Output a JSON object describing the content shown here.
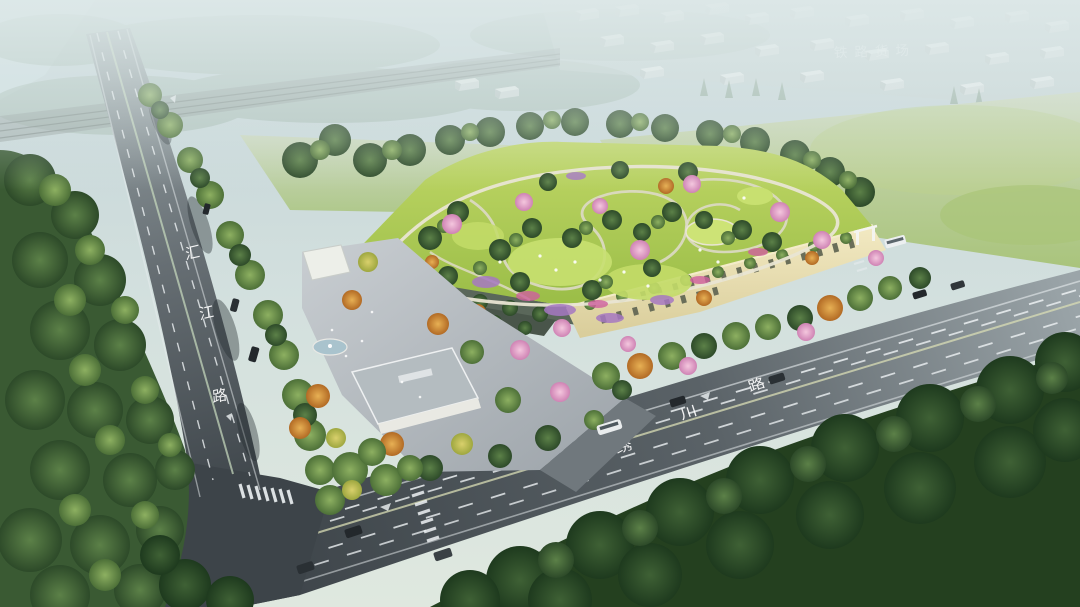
{
  "labels": {
    "railway_yard": "铁路货场"
  },
  "roads": {
    "left": {
      "name": "汇江路",
      "chars": [
        "汇",
        "江",
        "路"
      ]
    },
    "front": {
      "name": "绣川路",
      "chars": [
        "绣",
        "川",
        "路"
      ]
    }
  },
  "palette": {
    "haze_sky": "#c6d6d8",
    "meadow": "#b2c985",
    "roof_lawn": "#aacf52",
    "asphalt_near": "#42494e",
    "asphalt_far": "#9aa4a8",
    "facade": "#ece2b4",
    "flower_pink": "#dd9ec9",
    "flower_purple": "#a678c2",
    "tree_foreground": "#2c4727",
    "road_marking": "#edf1f3"
  }
}
